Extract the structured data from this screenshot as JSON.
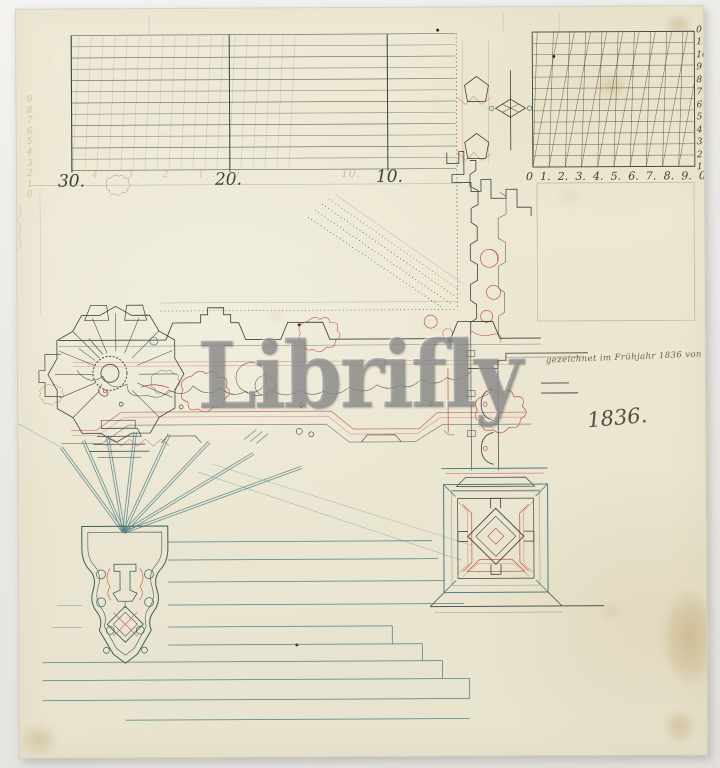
{
  "artwork": {
    "watermark": "Librifly",
    "inscription": "gezeichnet im Frühjahr 1836 von Th. Lindau.",
    "date_inscription": "1836."
  },
  "left_scale": {
    "labels": [
      "30.",
      "20.",
      "10."
    ],
    "ghost_label": "10.",
    "ghost_row": "4. 3. 2. 1. 0",
    "margin_digits": "9\n8\n7\n6\n5\n4\n3\n2\n1\n0"
  },
  "diagonal_scale": {
    "bottom_labels": [
      "0",
      "1.",
      "2.",
      "3.",
      "4.",
      "5.",
      "6.",
      "7.",
      "8.",
      "9.",
      "0"
    ],
    "right_labels": [
      "0",
      "11",
      "10",
      "9",
      "8",
      "7",
      "6",
      "5",
      "4",
      "3",
      "2",
      "1"
    ]
  },
  "colors": {
    "paper": "#ece8d4",
    "backdrop": "#e7e5e2",
    "ink_black": "#3f4238",
    "ink_red": "#c2554a",
    "ink_teal": "#4e7f86",
    "ink_dark_teal": "#3f6059",
    "ink_sepia": "#6b604c",
    "pencil": "#9a9a8a",
    "ink_text": "#3c4034",
    "sepia_text": "#6b604c",
    "ghost_pink": "#cf9a8e",
    "pencil_text": "#9aa08c",
    "stain": "#b28f52",
    "watermark_gray": "#8a8a8a"
  }
}
